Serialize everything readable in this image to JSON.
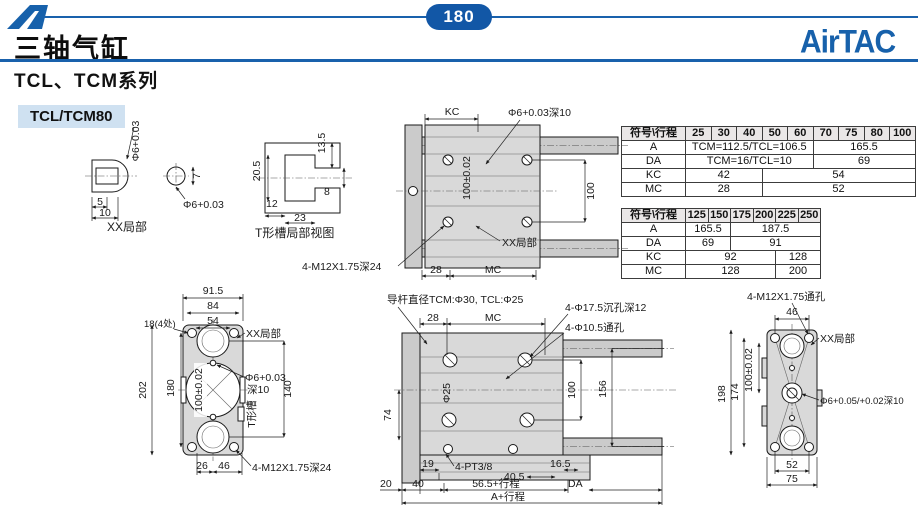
{
  "page": {
    "number": "180",
    "title": "三轴气缸",
    "subtitle": "TCL、TCM系列",
    "model": "TCL/TCM80",
    "brand": "AirTAC"
  },
  "colors": {
    "brand_blue": "#1961ac",
    "chip_bg": "#cfe1f1",
    "table_header_bg": "#eae7e7",
    "drawing_gray": "#d9d9d9"
  },
  "tables": [
    {
      "header": [
        "符号\\行程",
        "25",
        "30",
        "40",
        "50",
        "60",
        "70",
        "75",
        "80",
        "100"
      ],
      "rows": [
        {
          "label": "A",
          "cells": [
            {
              "text": "TCM=112.5/TCL=106.5",
              "span": 5
            },
            {
              "text": "165.5",
              "span": 4
            }
          ]
        },
        {
          "label": "DA",
          "cells": [
            {
              "text": "TCM=16/TCL=10",
              "span": 5
            },
            {
              "text": "69",
              "span": 4
            }
          ]
        },
        {
          "label": "KC",
          "cells": [
            {
              "text": "42",
              "span": 3
            },
            {
              "text": "54",
              "span": 6
            }
          ]
        },
        {
          "label": "MC",
          "cells": [
            {
              "text": "28",
              "span": 3
            },
            {
              "text": "52",
              "span": 6
            }
          ]
        }
      ]
    },
    {
      "header": [
        "符号\\行程",
        "125",
        "150",
        "175",
        "200",
        "225",
        "250"
      ],
      "rows": [
        {
          "label": "A",
          "cells": [
            {
              "text": "165.5",
              "span": 2
            },
            {
              "text": "187.5",
              "span": 4
            }
          ]
        },
        {
          "label": "DA",
          "cells": [
            {
              "text": "69",
              "span": 2
            },
            {
              "text": "91",
              "span": 4
            }
          ]
        },
        {
          "label": "KC",
          "cells": [
            {
              "text": "92",
              "span": 4
            },
            {
              "text": "128",
              "span": 2
            }
          ]
        },
        {
          "label": "MC",
          "cells": [
            {
              "text": "128",
              "span": 4
            },
            {
              "text": "200",
              "span": 2
            }
          ]
        }
      ]
    }
  ],
  "drawings": {
    "detail": {
      "phi6_top": "Φ6+0.03",
      "dim_5": "5",
      "dim_10": "10",
      "dim_7": "7",
      "phi6_side": "Φ6+0.03",
      "caption": "XX局部"
    },
    "tslot": {
      "dim_205": "20.5",
      "dim_135": "13.5",
      "dim_8": "8",
      "dim_12": "12",
      "dim_23": "23",
      "caption": "T形槽局部视图"
    },
    "top_view": {
      "kc": "KC",
      "hole_note": "Φ6+0.03深10",
      "dim_100_tol": "100±0.02",
      "dim_100": "100",
      "xx_label": "XX局部",
      "screw_note": "4-M12X1.75深24",
      "dim_28": "28",
      "mc": "MC"
    },
    "front_view": {
      "dim_915": "91.5",
      "dim_84": "84",
      "dim_54": "54",
      "dim_18": "18(4处)",
      "dim_202": "202",
      "dim_180": "180",
      "dim_100_tol": "100±0.02",
      "xx_label": "XX局部",
      "hole_note": "Φ6+0.03",
      "hole_depth": "深10",
      "dim_140": "140",
      "tslot_label": "T形槽",
      "dim_26": "26",
      "dim_46": "46",
      "screw_note": "4-M12X1.75深24"
    },
    "side_view": {
      "rod_note": "导杆直径TCM:Φ30, TCL:Φ25",
      "dim_28": "28",
      "mc": "MC",
      "counterbore_note": "4-Φ17.5沉孔深12",
      "through_note": "4-Φ10.5通孔",
      "dim_74": "74",
      "phi_25": "Φ25",
      "dim_100": "100",
      "dim_156": "156",
      "dim_19": "19",
      "port_note": "4-PT3/8",
      "dim_165": "16.5",
      "dim_405": "40.5",
      "dim_20": "20",
      "dim_40": "40",
      "stroke_565": "56.5+行程",
      "da": "DA",
      "a_stroke": "A+行程"
    },
    "rear_view": {
      "screw_note": "4-M12X1.75通孔",
      "dim_46": "46",
      "xx_label": "XX局部",
      "dim_198": "198",
      "dim_174": "174",
      "dim_100_tol": "100±0.02",
      "hole_note": "Φ6+0.05/+0.02深10",
      "dim_52": "52",
      "dim_75": "75"
    }
  }
}
